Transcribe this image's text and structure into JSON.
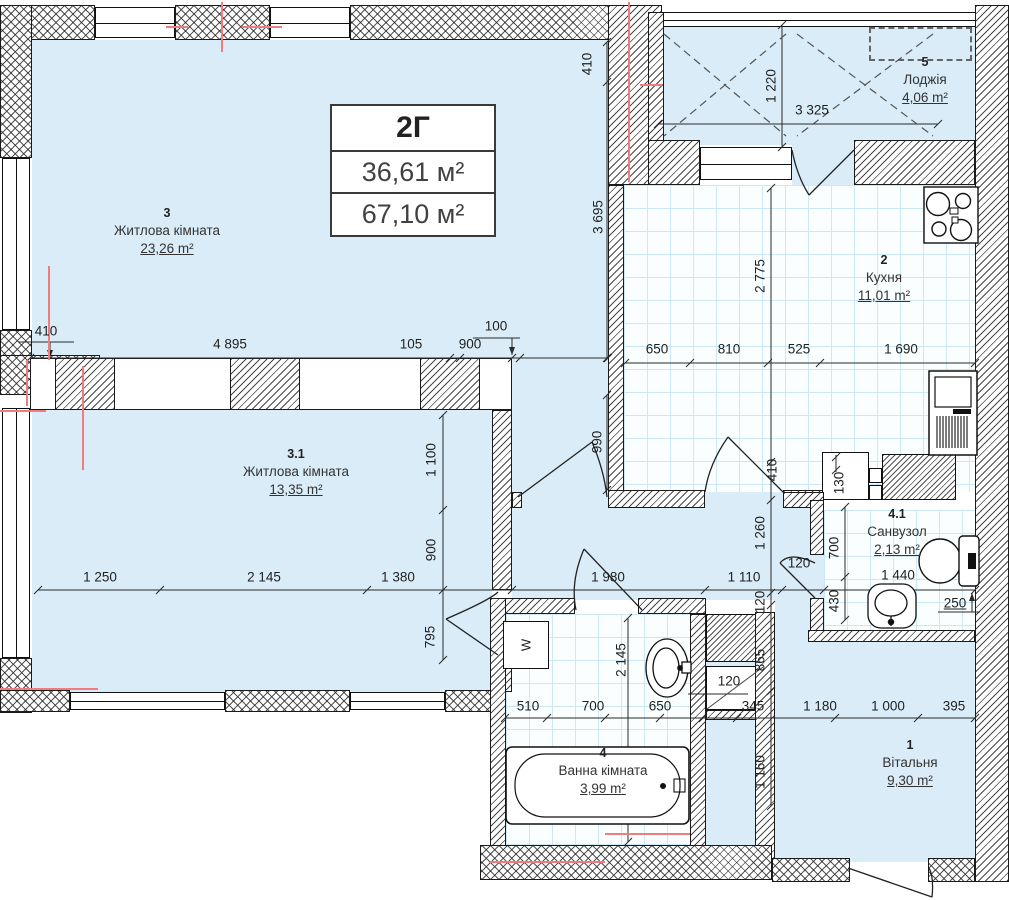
{
  "title_block": {
    "type_label": "2Г",
    "living_area": "36,61 м²",
    "total_area": "67,10 м²"
  },
  "rooms": [
    {
      "number": "3",
      "name": "Житлова кімната",
      "area": "23,26 m²"
    },
    {
      "number": "3.1",
      "name": "Житлова кімната",
      "area": "13,35 m²"
    },
    {
      "number": "2",
      "name": "Кухня",
      "area": "11,01 m²"
    },
    {
      "number": "5",
      "name": "Лоджія",
      "area": "4,06 m²"
    },
    {
      "number": "4.1",
      "name": "Санвузол",
      "area": "2,13 m²"
    },
    {
      "number": "4",
      "name": "Ванна кімната",
      "area": "3,99 m²"
    },
    {
      "number": "1",
      "name": "Вітальня",
      "area": "9,30 m²"
    }
  ],
  "dims": {
    "h": [
      "410",
      "4 895",
      "105",
      "900",
      "100",
      "650",
      "810",
      "525",
      "1 690",
      "3 325",
      "1 250",
      "2 145",
      "1 380",
      "1 980",
      "1 110",
      "120",
      "1 440",
      "250",
      "510",
      "700",
      "650",
      "345",
      "1 180",
      "1 000",
      "395",
      "120"
    ],
    "v": [
      "410",
      "3 695",
      "1 220",
      "2 775",
      "410",
      "990",
      "1 100",
      "900",
      "795",
      "1 260",
      "120",
      "865",
      "1 160",
      "130",
      "700",
      "430",
      "2 145"
    ]
  },
  "fixtures": {
    "washer_label": "W"
  },
  "colors": {
    "floor": "#daecf8",
    "tile_line": "#cde8f5",
    "wall_line": "#1a1a1a",
    "centerline": "#f07d7d",
    "dim_text": "#1f1f1f"
  }
}
